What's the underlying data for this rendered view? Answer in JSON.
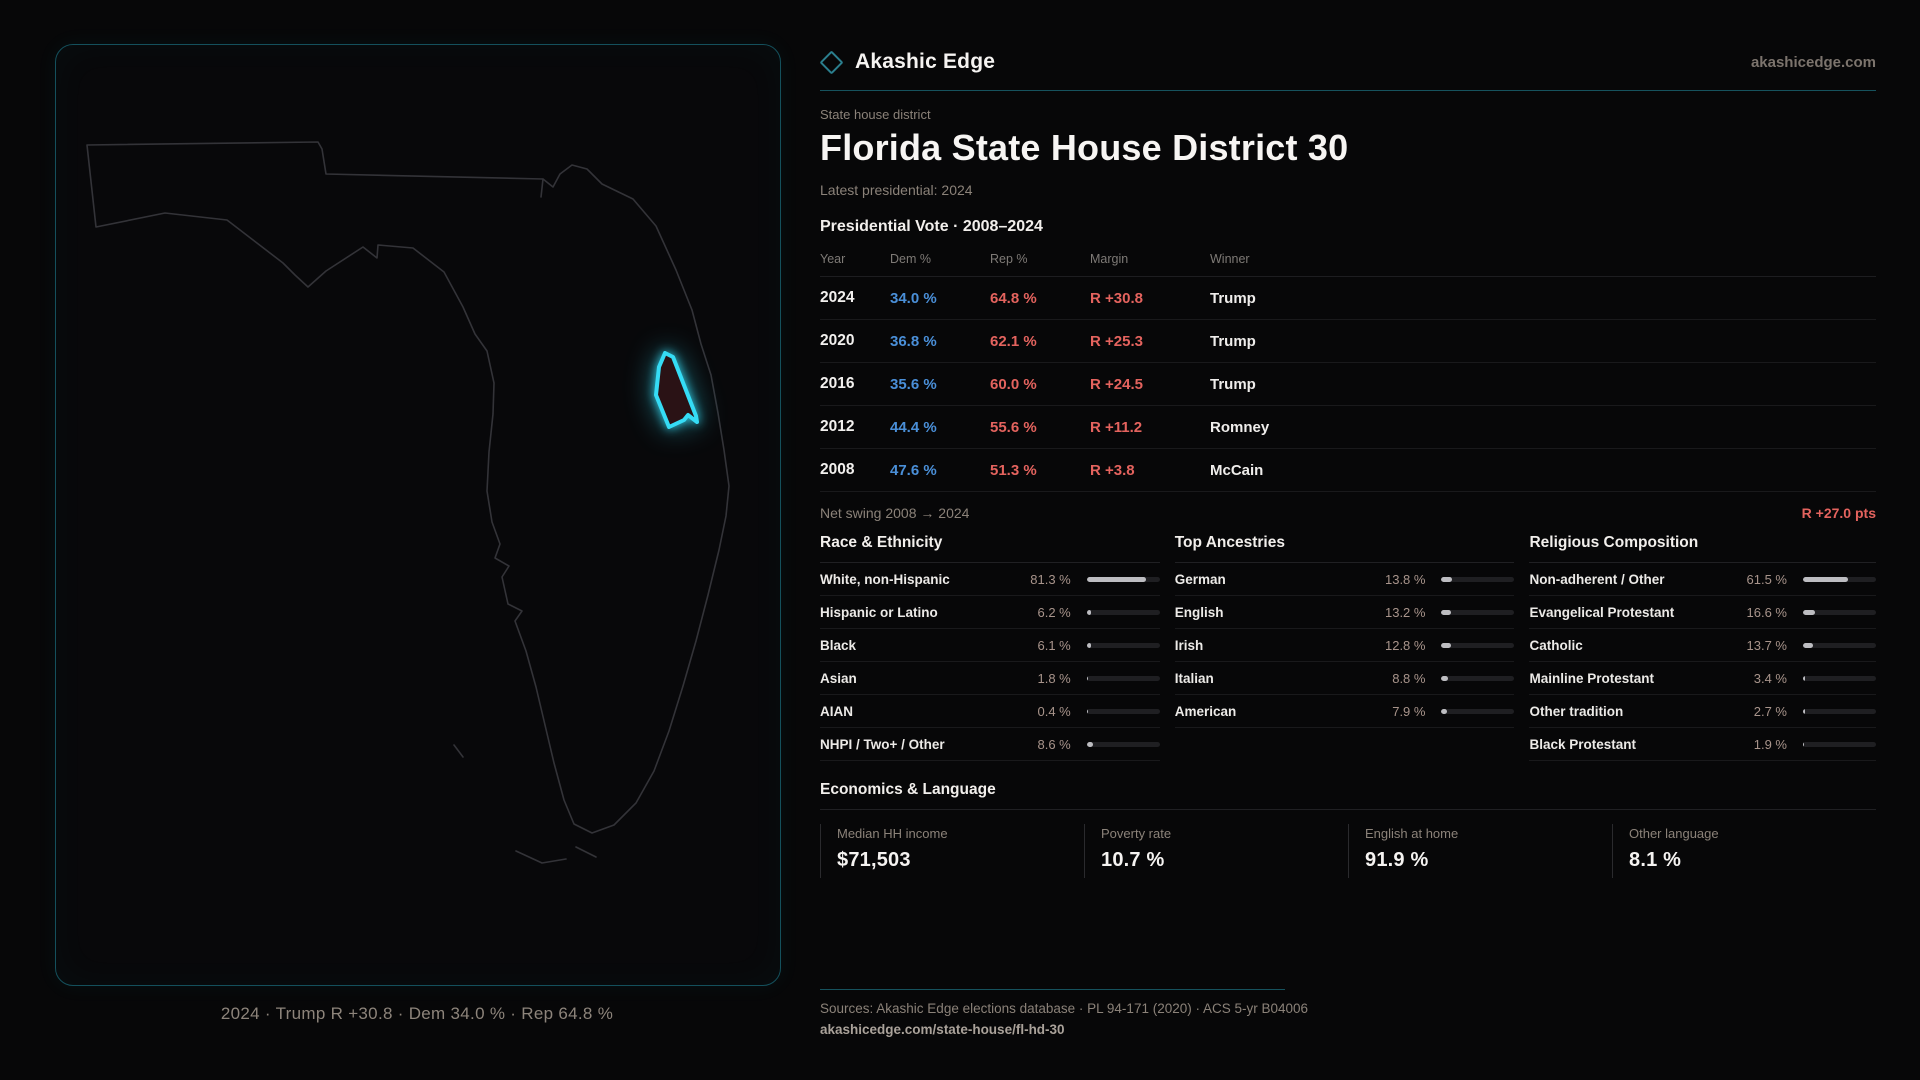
{
  "brand": {
    "name": "Akashic Edge",
    "domain": "akashicedge.com"
  },
  "page": {
    "kicker": "State house district",
    "title": "Florida State House District 30",
    "latest_label": "Latest presidential: 2024"
  },
  "map": {
    "caption": "2024 · Trump R +30.8 · Dem 34.0 % · Rep 64.8 %"
  },
  "vote_table": {
    "title": "Presidential Vote · 2008–2024",
    "columns": [
      "Year",
      "Dem %",
      "Rep %",
      "Margin",
      "Winner"
    ],
    "rows": [
      {
        "year": "2024",
        "dem": "34.0 %",
        "rep": "64.8 %",
        "margin": "R +30.8",
        "winner": "Trump"
      },
      {
        "year": "2020",
        "dem": "36.8 %",
        "rep": "62.1 %",
        "margin": "R +25.3",
        "winner": "Trump"
      },
      {
        "year": "2016",
        "dem": "35.6 %",
        "rep": "60.0 %",
        "margin": "R +24.5",
        "winner": "Trump"
      },
      {
        "year": "2012",
        "dem": "44.4 %",
        "rep": "55.6 %",
        "margin": "R +11.2",
        "winner": "Romney"
      },
      {
        "year": "2008",
        "dem": "47.6 %",
        "rep": "51.3 %",
        "margin": "R +3.8",
        "winner": "McCain"
      }
    ]
  },
  "net_swing": {
    "label": "Net swing 2008 → 2024",
    "value": "R +27.0 pts"
  },
  "demographics": [
    {
      "title": "Race & Ethnicity",
      "rows": [
        {
          "label": "White, non-Hispanic",
          "value": "81.3 %",
          "pct": 81.3
        },
        {
          "label": "Hispanic or Latino",
          "value": "6.2 %",
          "pct": 6.2
        },
        {
          "label": "Black",
          "value": "6.1 %",
          "pct": 6.1
        },
        {
          "label": "Asian",
          "value": "1.8 %",
          "pct": 1.8
        },
        {
          "label": "AIAN",
          "value": "0.4 %",
          "pct": 0.4
        },
        {
          "label": "NHPI / Two+ / Other",
          "value": "8.6 %",
          "pct": 8.6
        }
      ]
    },
    {
      "title": "Top Ancestries",
      "rows": [
        {
          "label": "German",
          "value": "13.8 %",
          "pct": 13.8
        },
        {
          "label": "English",
          "value": "13.2 %",
          "pct": 13.2
        },
        {
          "label": "Irish",
          "value": "12.8 %",
          "pct": 12.8
        },
        {
          "label": "Italian",
          "value": "8.8 %",
          "pct": 8.8
        },
        {
          "label": "American",
          "value": "7.9 %",
          "pct": 7.9
        }
      ]
    },
    {
      "title": "Religious Composition",
      "rows": [
        {
          "label": "Non-adherent / Other",
          "value": "61.5 %",
          "pct": 61.5
        },
        {
          "label": "Evangelical Protestant",
          "value": "16.6 %",
          "pct": 16.6
        },
        {
          "label": "Catholic",
          "value": "13.7 %",
          "pct": 13.7
        },
        {
          "label": "Mainline Protestant",
          "value": "3.4 %",
          "pct": 3.4
        },
        {
          "label": "Other tradition",
          "value": "2.7 %",
          "pct": 2.7
        },
        {
          "label": "Black Protestant",
          "value": "1.9 %",
          "pct": 1.9
        }
      ]
    }
  ],
  "economics": {
    "title": "Economics & Language",
    "stats": [
      {
        "label": "Median HH income",
        "value": "$71,503"
      },
      {
        "label": "Poverty rate",
        "value": "10.7 %"
      },
      {
        "label": "English at home",
        "value": "91.9 %"
      },
      {
        "label": "Other language",
        "value": "8.1 %"
      }
    ]
  },
  "footer": {
    "sources": "Sources: Akashic Edge elections database · PL 94-171 (2020) · ACS 5-yr B04006",
    "permalink": "akashicedge.com/state-house/fl-hd-30"
  },
  "colors": {
    "accent_teal": "#2bd4ee",
    "dem_blue": "#4a8fd8",
    "rep_red": "#e4635e",
    "bar_fill": "#bdbdc1"
  }
}
